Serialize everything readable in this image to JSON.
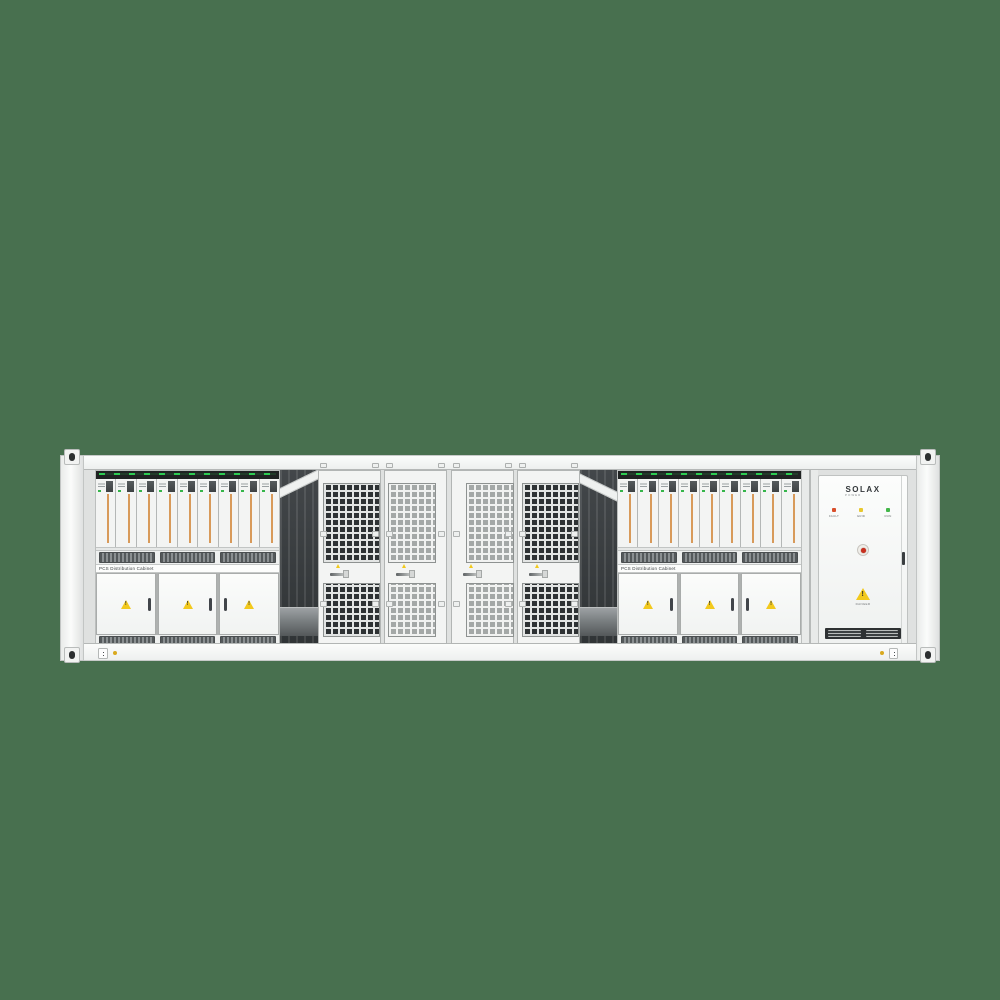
{
  "scene": {
    "background_color": "#48704F"
  },
  "container": {
    "left_pcs_rack": {
      "label": "PCS Distribution Cabinet",
      "module_count": 9,
      "door_count": 3
    },
    "right_pcs_rack": {
      "label": "PCS Distribution Cabinet",
      "module_count": 9,
      "door_count": 3
    },
    "mesh_doors": {
      "count": 4
    },
    "solax_cabinet": {
      "brand": "SOLAX",
      "brand_sub": "POWER",
      "leds": [
        {
          "name": "fault-led",
          "color": "#d94f2b",
          "label": "FAULT"
        },
        {
          "name": "grid-led",
          "color": "#e8c82e",
          "label": "GRID"
        },
        {
          "name": "run-led",
          "color": "#43b649",
          "label": "RUN"
        }
      ],
      "warning_label": "DANGER"
    },
    "colors": {
      "warning_yellow": "#f2c91d",
      "module_strip_orange": "#d89a5a",
      "module_led_green": "#35b54a",
      "estop_red": "#c9301f"
    }
  }
}
